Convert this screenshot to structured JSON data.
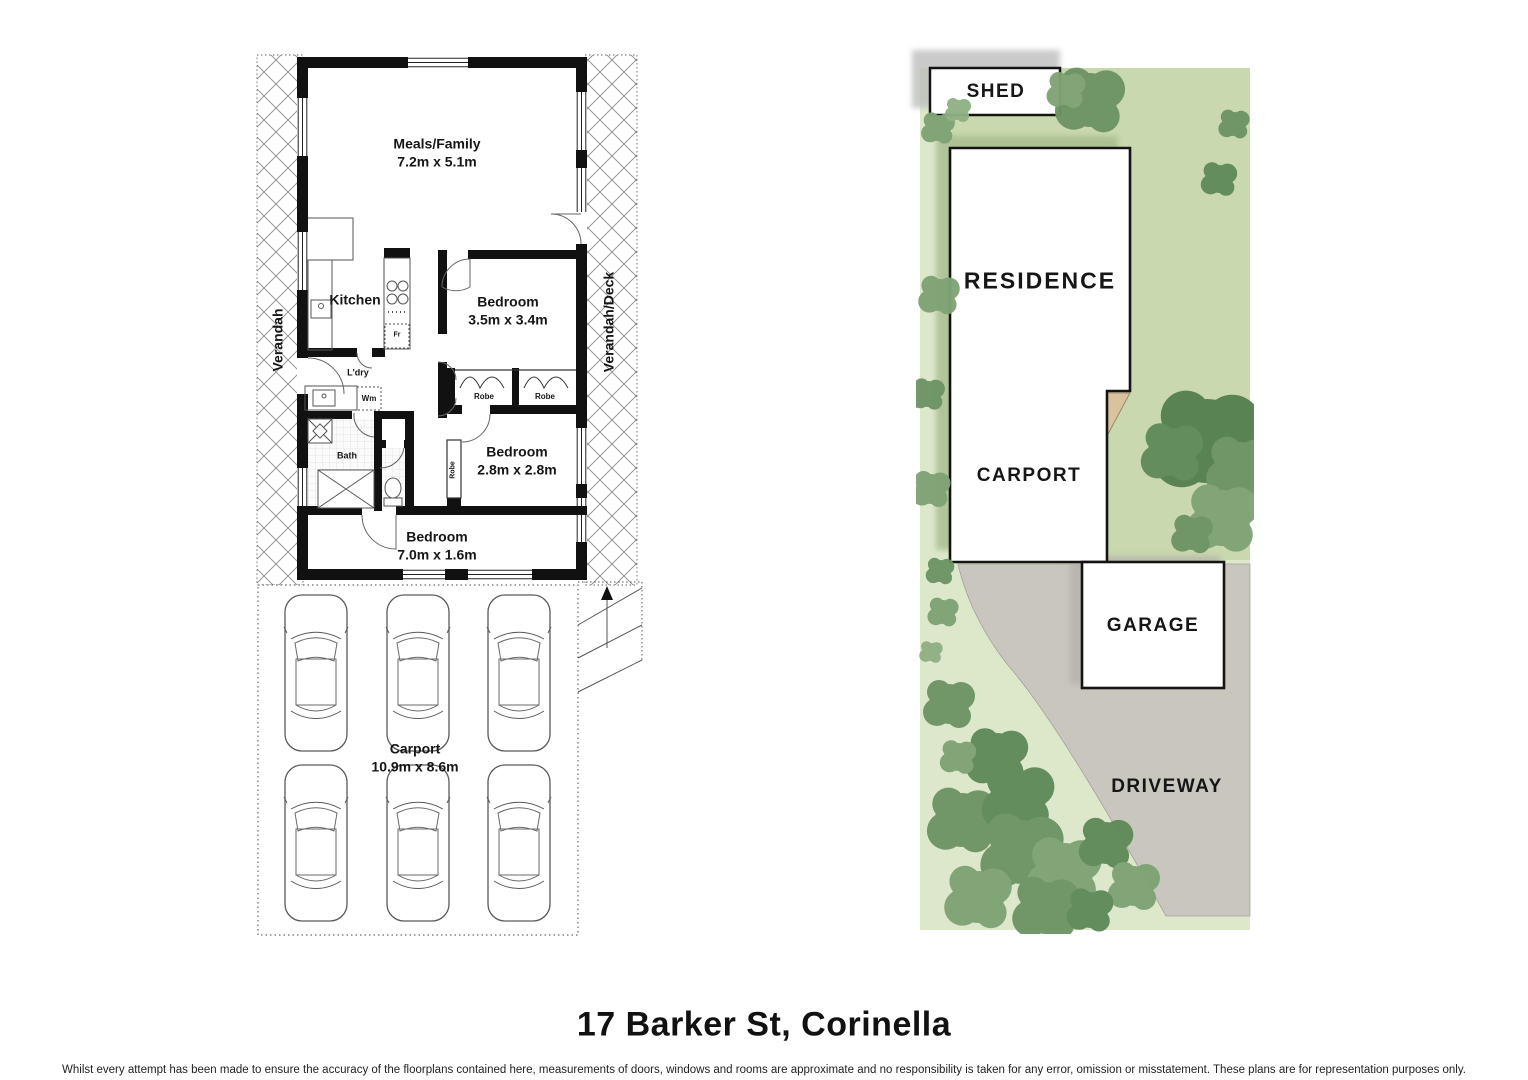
{
  "floorplan": {
    "rooms": {
      "meals_family": {
        "label": "Meals/Family",
        "dims": "7.2m x 5.1m"
      },
      "kitchen": {
        "label": "Kitchen"
      },
      "bedroom1": {
        "label": "Bedroom",
        "dims": "3.5m x 3.4m"
      },
      "bedroom2": {
        "label": "Bedroom",
        "dims": "2.8m x 2.8m"
      },
      "bedroom3": {
        "label": "Bedroom",
        "dims": "7.0m x 1.6m"
      },
      "carport": {
        "label": "Carport",
        "dims": "10.9m x 8.6m"
      },
      "bath": {
        "label": "Bath"
      },
      "laundry": {
        "label": "L'dry"
      },
      "washing_machine": {
        "label": "Wm"
      },
      "fridge": {
        "label": "Fr"
      },
      "robe_left": {
        "label": "Robe"
      },
      "robe_right": {
        "label": "Robe"
      },
      "robe_vertical": {
        "label": "Robe"
      },
      "verandah": {
        "label": "Verandah"
      },
      "verandah_deck": {
        "label": "Verandah/Deck"
      }
    }
  },
  "siteplan": {
    "shed": "SHED",
    "residence": "RESIDENCE",
    "carport": "CARPORT",
    "garage": "GARAGE",
    "driveway": "DRIVEWAY"
  },
  "footer": {
    "title": "17 Barker St, Corinella",
    "disclaimer": "Whilst every attempt has been made to ensure the accuracy of the floorplans contained here, measurements of doors, windows and rooms are approximate and no responsibility is taken for any error, omission or misstatement. These plans are for representation purposes only."
  },
  "colors": {
    "wall": "#111111",
    "lot_green": "#c9d8ae",
    "lot_light_green": "#dde8ca",
    "driveway_grey": "#c9c5bf",
    "tan_wedge": "#d9c29e",
    "tree_dark": "#55804f",
    "tree_mid": "#6d9465",
    "tree_light": "#8fb084"
  }
}
